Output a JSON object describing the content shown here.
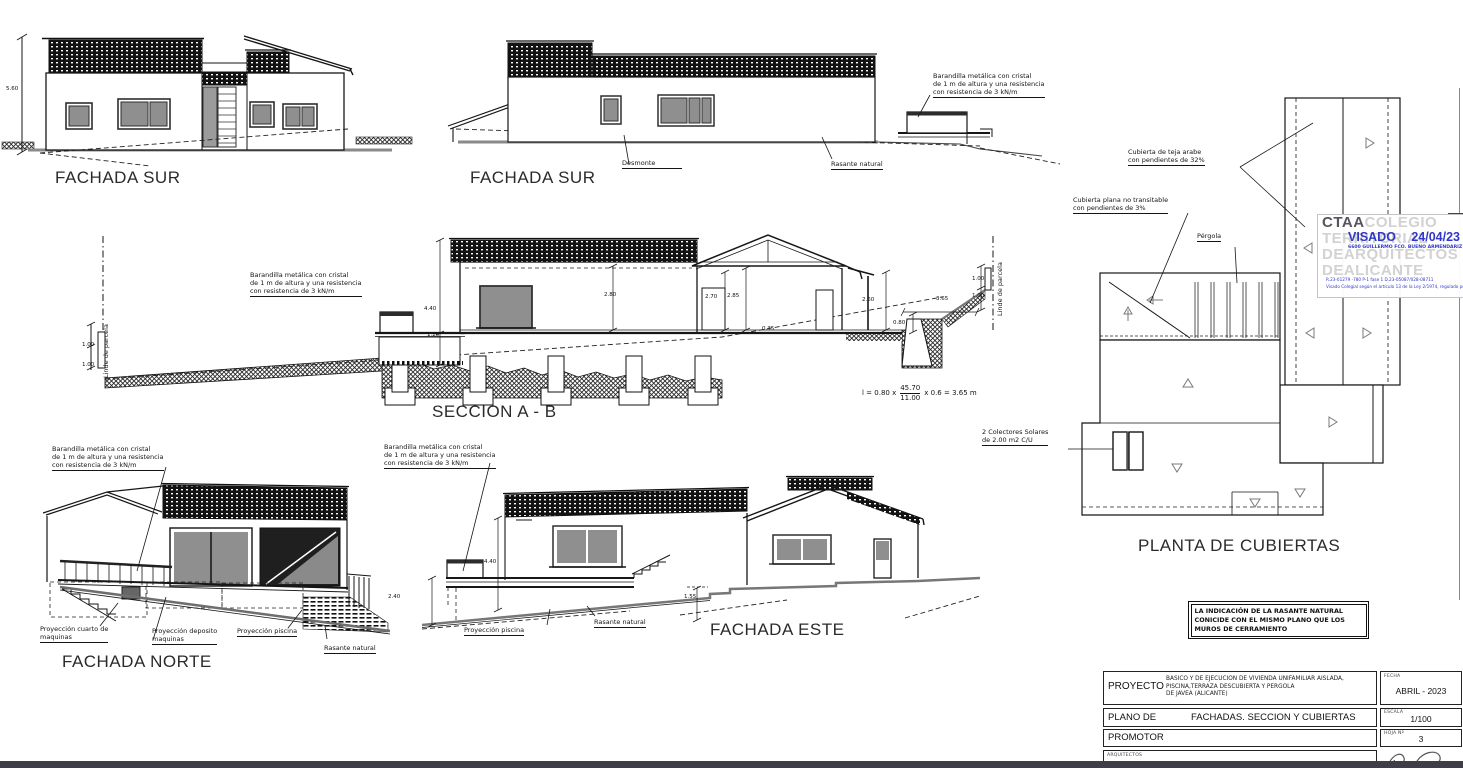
{
  "labels": {
    "fachada_sur": "FACHADA SUR",
    "seccion": "SECCION A - B",
    "fachada_norte": "FACHADA NORTE",
    "fachada_este": "FACHADA ESTE",
    "planta_cubiertas": "PLANTA DE CUBIERTAS"
  },
  "annotations": {
    "barandilla": [
      "Barandilla metálica con cristal",
      "de 1 m de altura y una resistencia",
      "con resistencia de  3 kN/m"
    ],
    "desmonte": "Desmonte",
    "rasante_natural": "Rasante natural",
    "linde_parcela": "Linde de parcela",
    "cubierta_teja": [
      "Cubierta de teja arabe",
      "con pendientes de 32%"
    ],
    "cubierta_plana": [
      "Cubierta plana no transitable",
      "con pendientes de 3%"
    ],
    "pergola": "Pérgola",
    "colectores": [
      "2 Colectores Solares",
      "de 2.00 m2 C/U"
    ],
    "proyeccion_cuarto": [
      "Proyección cuarto de",
      "maquinas"
    ],
    "proyeccion_deposito": [
      "Proyección deposito",
      "maquinas"
    ],
    "proyeccion_piscina": "Proyección piscina",
    "formula": {
      "lead": "l  =  0.80  x",
      "num": "45.70",
      "den": "11.00",
      "tail": "x  0.6  =  3.65  m"
    }
  },
  "dimensions": {
    "sur_altura": "5.60",
    "sec_440": "4.40",
    "sec_120": "1.20",
    "sec_280": "2.80",
    "sec_270": "2.70",
    "sec_285": "2.85",
    "sec_260": "2.60",
    "sec_080": "0.80",
    "sec_365": "3.65",
    "sec_100": "1.00",
    "sec_035": "0.35",
    "este_240": "2.40",
    "este_440": "4.40",
    "este_155": "1.55"
  },
  "stamp": {
    "ctaa": "CTAA",
    "colegio": "COLEGIO",
    "territorial": "TERRITORIAL",
    "dearquitectos": "DEARQUITECTOS",
    "dealicante": "DEALICANTE",
    "visado": "VISADO",
    "fecha": "24/04/23",
    "colegiado": "6600 GUILLERMO FCO. BUENO ARMENDARIZ",
    "ref_line": "R.23-01279 -780      P-1 fase 1      D.23-05087/028-08711",
    "legal_line": "Visado Colegial según el artículo 13 de la Ley 2/1974, regulado por la Ley 25 com"
  },
  "note_box": [
    "LA  INDICACIÓN  DE  LA RASANTE NATURAL",
    "CONICIDE   CON EL MISMO PLANO QUE LOS",
    "MUROS  DE  CERRAMIENTO"
  ],
  "title_block": {
    "proyecto_label": "PROYECTO",
    "proyecto_lines": [
      "BASICO  Y  DE EJECUCION  DE  VIVIENDA  UNIFAMILIAR  AISLADA,",
      "PISCINA,TERRAZA DESCUBIERTA Y PERGOLA",
      "DE JAVEA (ALICANTE)"
    ],
    "fecha_label": "FECHA",
    "fecha_value": "ABRIL - 2023",
    "plano_label": "PLANO DE",
    "plano_value": "FACHADAS. SECCION Y CUBIERTAS",
    "escala_label": "ESCALA",
    "escala_value": "1/100",
    "promotor_label": "PROMOTOR",
    "hoja_label": "HOJA Nº",
    "hoja_value": "3",
    "arquitectos_label": "ARQUITECTOS"
  },
  "colors": {
    "visado_blue": "#3038c8",
    "watermark_gray": "#d2d2d2",
    "bottom_bar": "#3e3e47"
  }
}
